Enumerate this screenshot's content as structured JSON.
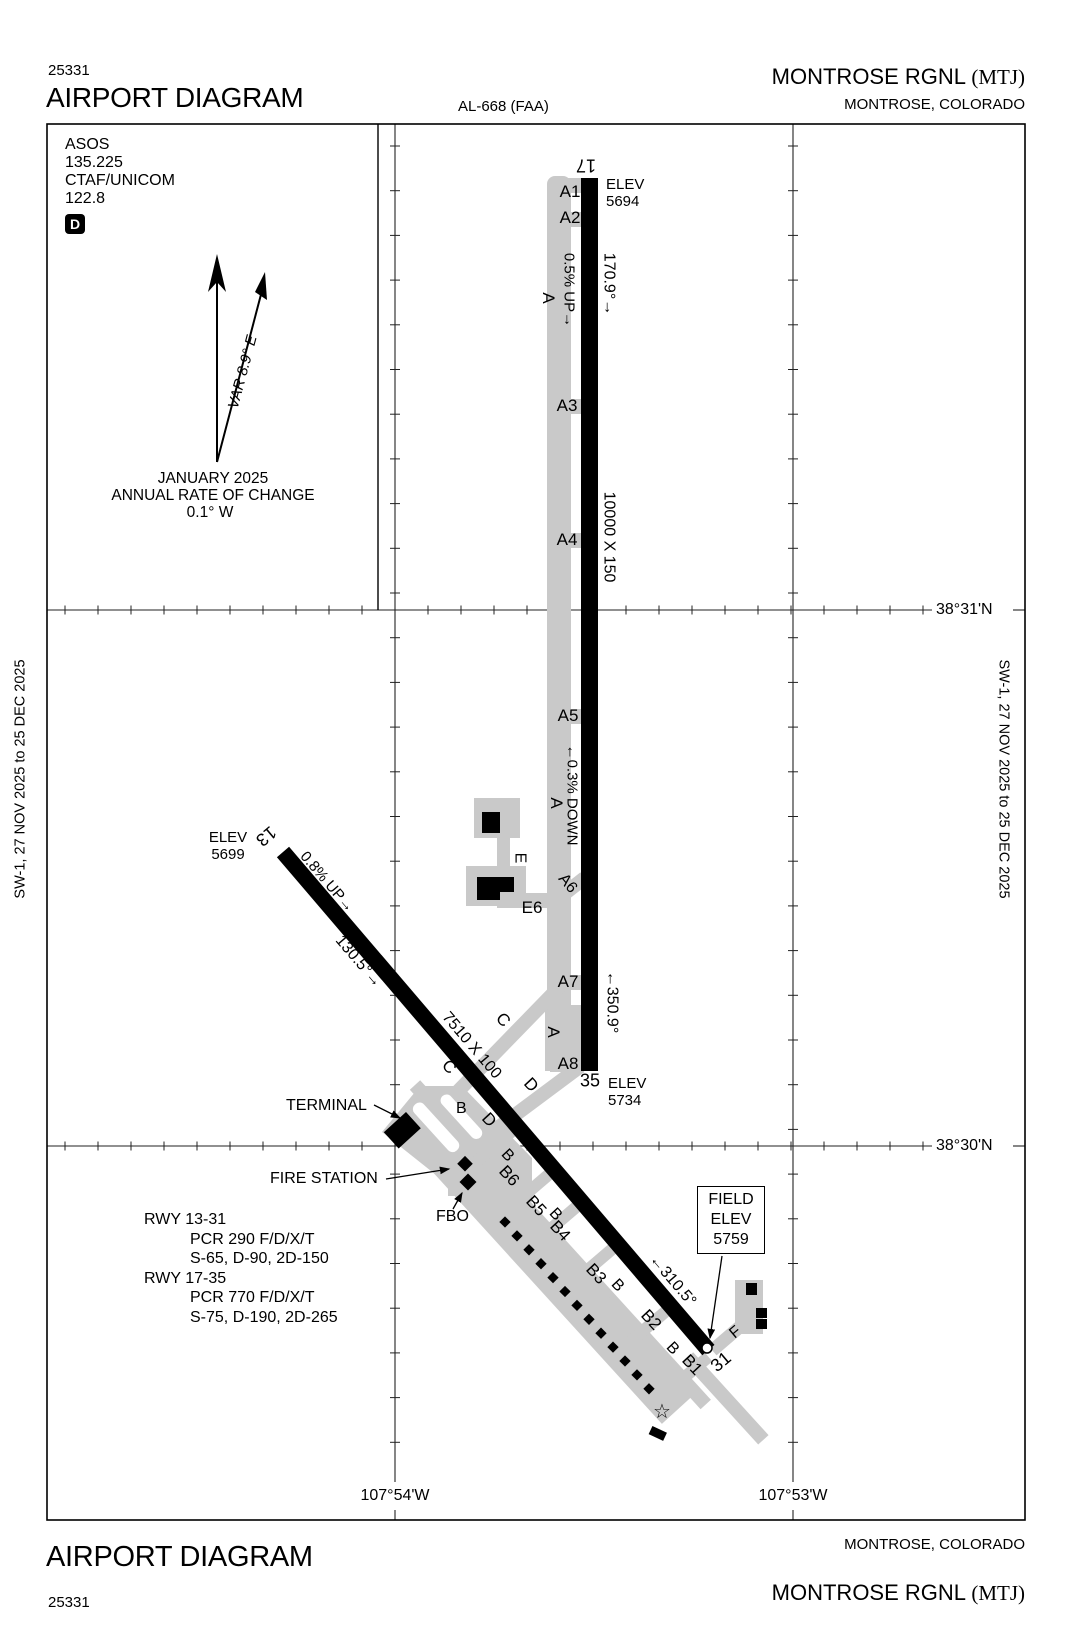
{
  "header": {
    "chart_number": "25331",
    "title": "AIRPORT DIAGRAM",
    "al_number": "AL-668 (FAA)",
    "airport_name": "MONTROSE RGNL",
    "airport_id": "(MTJ)",
    "city": "MONTROSE, COLORADO"
  },
  "footer": {
    "title": "AIRPORT DIAGRAM",
    "chart_number": "25331",
    "airport_name": "MONTROSE RGNL",
    "airport_id": "(MTJ)",
    "city": "MONTROSE, COLORADO"
  },
  "margin_notes": {
    "left": "SW-1, 27 NOV 2025 to 25 DEC 2025",
    "right": "SW-1, 27 NOV 2025 to 25 DEC 2025"
  },
  "comm": {
    "asos_label": "ASOS",
    "asos_freq": "135.225",
    "ctaf_label": "CTAF/UNICOM",
    "ctaf_freq": "122.8",
    "d_symbol": "D"
  },
  "compass": {
    "variation": "VAR 8.9° E",
    "date": "JANUARY 2025",
    "rate_label": "ANNUAL RATE OF CHANGE",
    "rate_value": "0.1° W"
  },
  "grid": {
    "lat_top": "38°31'N",
    "lat_bottom": "38°30'N",
    "lon_left": "107°54'W",
    "lon_right": "107°53'W"
  },
  "rwy1735": {
    "num_17": "17",
    "num_35": "35",
    "dims": "10000 X 150",
    "elev_17_l1": "ELEV",
    "elev_17_l2": "5694",
    "elev_35_l1": "ELEV",
    "elev_35_l2": "5734",
    "hdg_17": "170.9°→",
    "hdg_35": "←350.9°",
    "slope_n": "0.5% UP→",
    "slope_s": "←0.3% DOWN"
  },
  "rwy1331": {
    "num_13": "13",
    "num_31": "31",
    "dims": "7510 X 100",
    "elev_13_l1": "ELEV",
    "elev_13_l2": "5699",
    "slope": "0.8% UP→",
    "hdg_13": "130.5°→",
    "hdg_31": "←310.5°"
  },
  "field_elev": {
    "l1": "FIELD",
    "l2": "ELEV",
    "l3": "5759"
  },
  "pois": {
    "terminal": "TERMINAL",
    "fire_station": "FIRE STATION",
    "fbo": "FBO"
  },
  "data_block": {
    "rwy1": "RWY 13-31",
    "rwy1_pcr": "PCR 290 F/D/X/T",
    "rwy1_wt": "S-65, D-90, 2D-150",
    "rwy2": "RWY 17-35",
    "rwy2_pcr": "PCR 770 F/D/X/T",
    "rwy2_wt": "S-75, D-190, 2D-265"
  },
  "twy": {
    "a": "A",
    "a1": "A1",
    "a2": "A2",
    "a3": "A3",
    "a4": "A4",
    "a5": "A5",
    "a6": "A6",
    "a7": "A7",
    "a8": "A8",
    "b": "B",
    "b1": "B1",
    "b2": "B2",
    "b3": "B3",
    "b4": "B4",
    "b5": "B5",
    "b6": "B6",
    "c": "C",
    "d": "D",
    "e": "E",
    "e6": "E6",
    "f": "F"
  },
  "symbols": {
    "star": "☆"
  },
  "colors": {
    "taxiway_gray": "#c9c9c9",
    "runway_black": "#000000"
  }
}
